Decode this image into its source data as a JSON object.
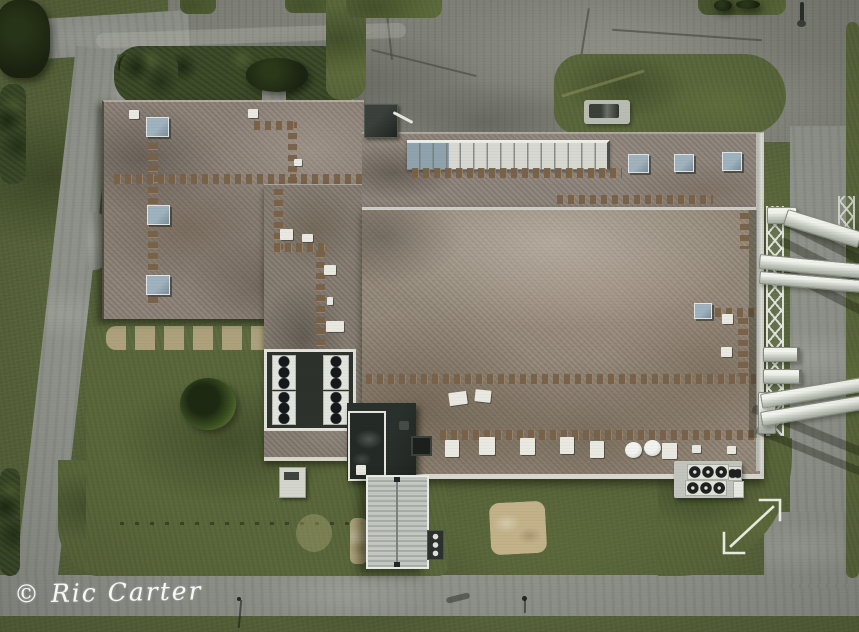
{
  "scene": {
    "type": "aerial-drone-photograph",
    "subject": "Top-down view of a flat-roofed industrial plant complex with gravel roofs, rooftop paver walkways, skylights, HVAC units, a white pipe rack exiting the right side, lawns and a perimeter loop road",
    "watermark": {
      "text": "© Ric Carter"
    },
    "overlay_icons": [
      {
        "name": "expand-diagonal-arrow-icon",
        "meaning": "expand / view-larger affordance",
        "glyph": "⤢"
      }
    ],
    "palette": {
      "grass": "#57633a",
      "grass_dark": "#39462a",
      "grass_light": "#6e7d45",
      "shrub": "#3e4c2a",
      "road": "#8f928a",
      "apron_asphalt": "#7f8178",
      "roof_gravel": "#8b8177",
      "roof_main": "#938879",
      "roof_brown_patch": "#6e6052",
      "roof_light_patch": "#b5ada1",
      "skylight_white": "#d8d8d2",
      "skylight_blue": "#9fb2bd",
      "paver_brown": "#7a6148",
      "dark_building": "#262b27",
      "white_trim": "#e7e7df",
      "metal_building": "#bcc0ba",
      "hvac_white": "#e1e4dd",
      "fan_dark": "#1d211f",
      "pipe_white": "#e3e6df",
      "sand": "#c3b289",
      "watermark_white": "#ffffff",
      "arrow_white": "#edf1e7"
    }
  }
}
